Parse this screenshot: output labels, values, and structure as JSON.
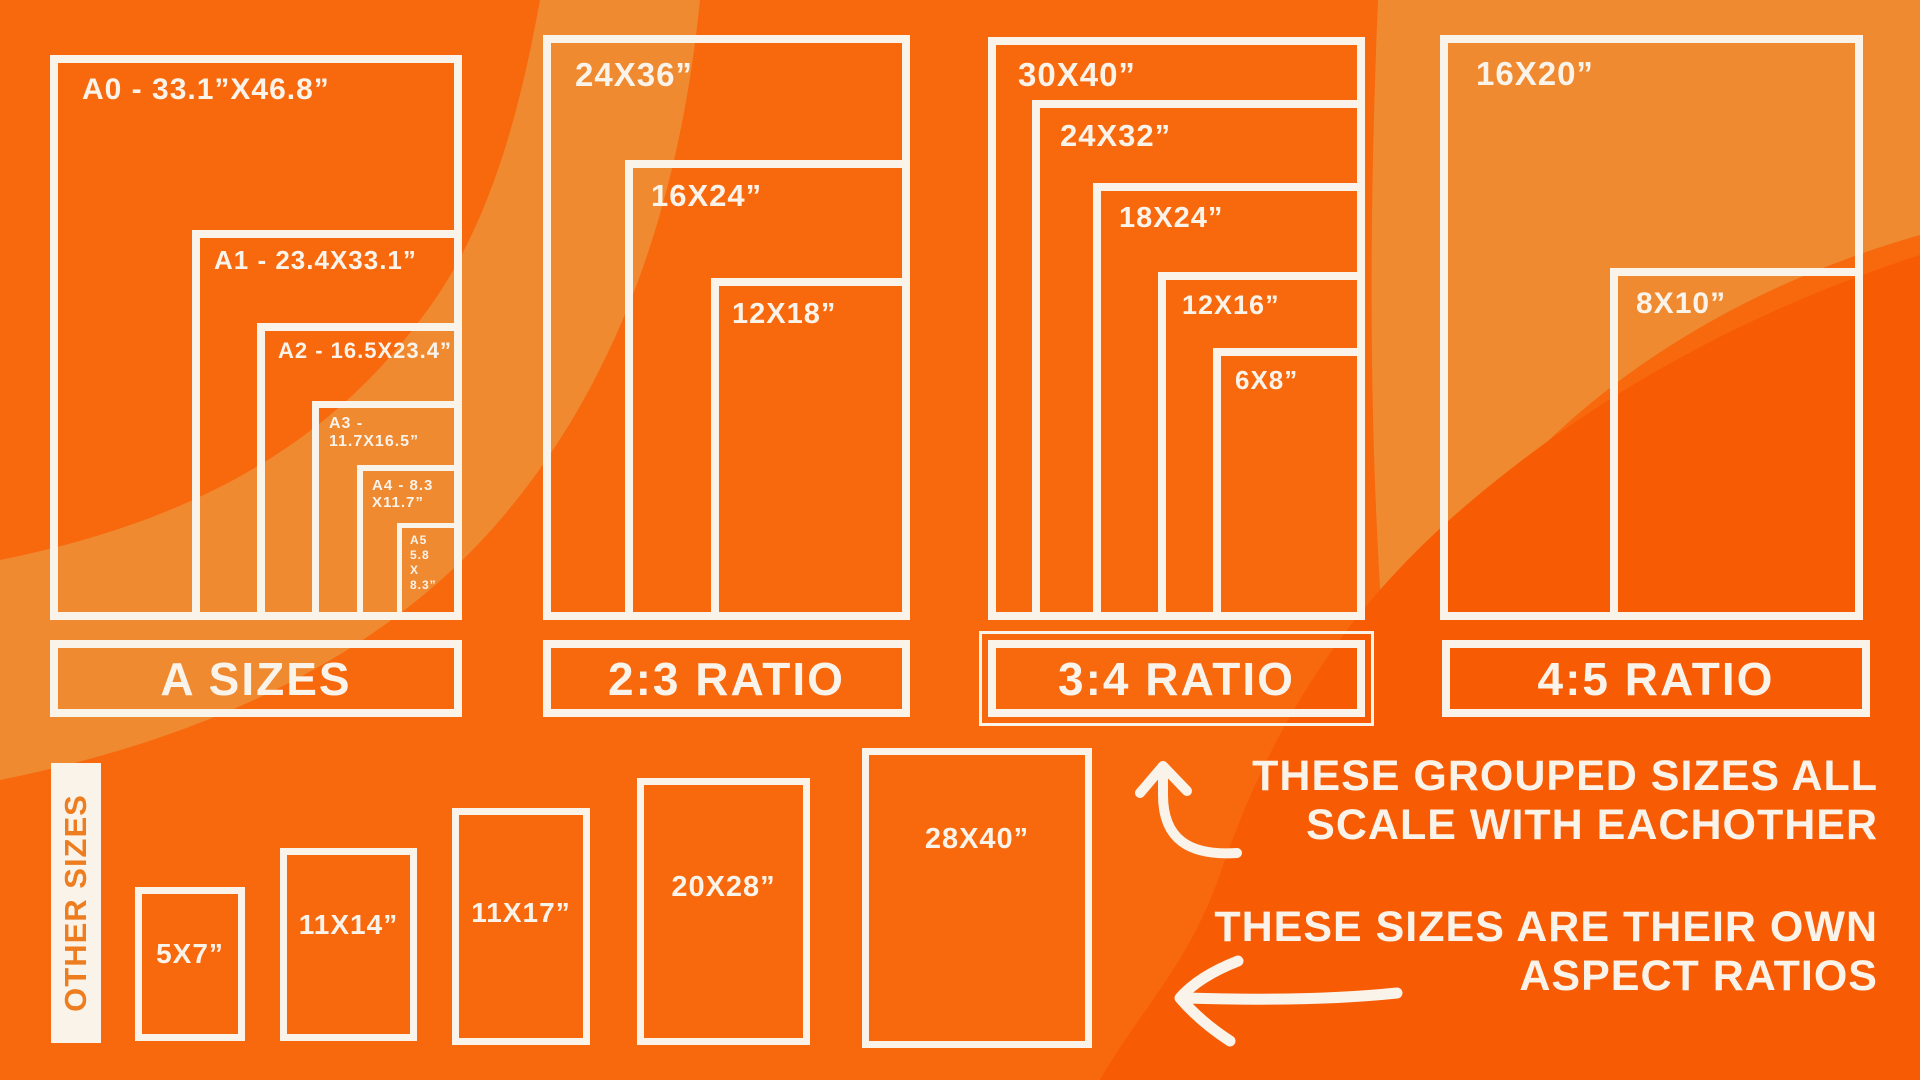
{
  "colors": {
    "base_orange": "#F8680D",
    "light_orange": "#EF8A31",
    "deep_orange": "#F75B03",
    "line_white": "#FAF3EA",
    "other_sizes_text_orange": "#EE7D1F"
  },
  "groups": [
    {
      "id": "a-sizes",
      "label": "A SIZES",
      "boxes": [
        {
          "id": "a0",
          "label": "A0 - 33.1”X46.8”"
        },
        {
          "id": "a1",
          "label": "A1 - 23.4X33.1”"
        },
        {
          "id": "a2",
          "label": "A2 - 16.5X23.4”"
        },
        {
          "id": "a3",
          "label": "A3 - 11.7X16.5”"
        },
        {
          "id": "a4",
          "label": "A4 - 8.3\nX11.7”"
        },
        {
          "id": "a5",
          "label": "A5\n5.8\nX\n8.3”"
        }
      ]
    },
    {
      "id": "ratio-2-3",
      "label": "2:3 RATIO",
      "boxes": [
        {
          "id": "24x36",
          "label": "24X36”"
        },
        {
          "id": "16x24",
          "label": "16X24”"
        },
        {
          "id": "12x18",
          "label": "12X18”"
        }
      ]
    },
    {
      "id": "ratio-3-4",
      "label": "3:4 RATIO",
      "boxes": [
        {
          "id": "30x40",
          "label": "30X40”"
        },
        {
          "id": "24x32",
          "label": "24X32”"
        },
        {
          "id": "18x24",
          "label": "18X24”"
        },
        {
          "id": "12x16",
          "label": "12X16”"
        },
        {
          "id": "6x8",
          "label": "6X8”"
        }
      ]
    },
    {
      "id": "ratio-4-5",
      "label": "4:5 RATIO",
      "boxes": [
        {
          "id": "16x20",
          "label": "16X20”"
        },
        {
          "id": "8x10",
          "label": "8X10”"
        }
      ]
    }
  ],
  "other_sizes": {
    "label": "OTHER SIZES",
    "boxes": [
      {
        "id": "5x7",
        "label": "5X7”"
      },
      {
        "id": "11x14",
        "label": "11X14”"
      },
      {
        "id": "11x17",
        "label": "11X17”"
      },
      {
        "id": "20x28",
        "label": "20X28”"
      },
      {
        "id": "28x40",
        "label": "28X40”"
      }
    ]
  },
  "notes": {
    "grouped": {
      "line1": "THESE GROUPED SIZES ALL",
      "line2": "SCALE WITH EACHOTHER"
    },
    "own": {
      "line1": "THESE SIZES ARE THEIR OWN",
      "line2": "ASPECT RATIOS"
    }
  },
  "icons": {
    "up_arrow": "curved-up-arrow",
    "left_arrow": "curved-left-arrow"
  }
}
